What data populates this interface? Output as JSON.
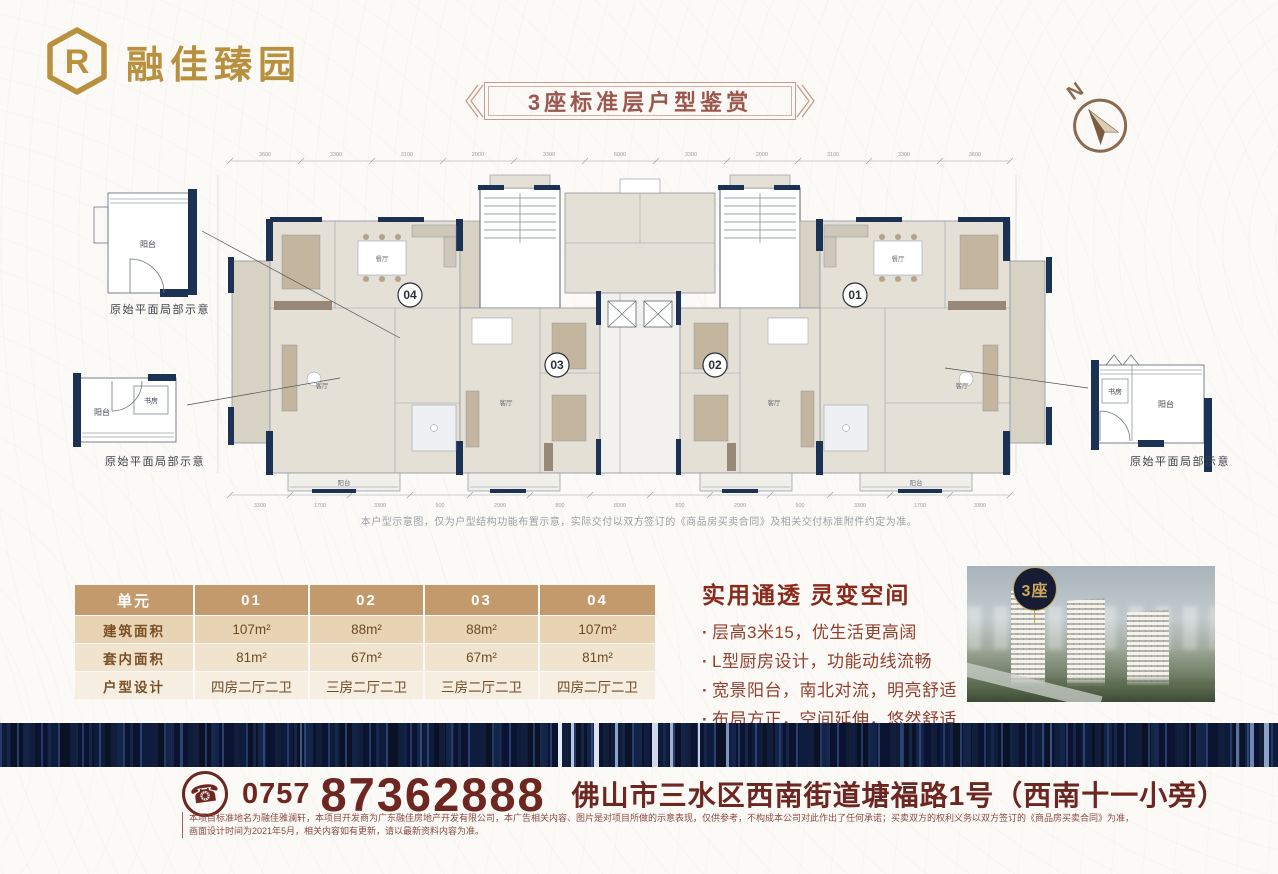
{
  "brand": {
    "logo_mark": "R",
    "logo_text": "融佳臻园"
  },
  "banner": {
    "title": "3座标准层户型鉴赏"
  },
  "compass": {
    "label": "N"
  },
  "floor_plan": {
    "unit_badges": [
      "04",
      "03",
      "02",
      "01"
    ],
    "room_labels": [
      "餐厅",
      "客厅",
      "阳台",
      "餐厅",
      "客厅",
      "阳台",
      "客厅",
      "客厅"
    ],
    "dimensions_top": [
      "3600",
      "3300",
      "3100",
      "2000",
      "3300",
      "6000",
      "3300",
      "2000",
      "3100",
      "3300",
      "3600"
    ],
    "dimensions_bottom": [
      "3300",
      "1700",
      "3300",
      "900",
      "2900",
      "800",
      "8000",
      "800",
      "2900",
      "900",
      "3300",
      "1700",
      "3300"
    ],
    "insets": [
      {
        "caption": "原始平面局部示意",
        "rooms": [
          "阳台"
        ]
      },
      {
        "caption": "原始平面局部示意",
        "rooms": [
          "阳台",
          "书房"
        ]
      },
      {
        "caption": "原始平面局部示意",
        "rooms": [
          "书房",
          "阳台"
        ]
      }
    ],
    "disclaimer": "本户型示意图，仅为户型结构功能布置示意，实际交付以双方签订的《商品房买卖合同》及相关交付标准附件约定为准。"
  },
  "units_table": {
    "headers": [
      "单元",
      "01",
      "02",
      "03",
      "04"
    ],
    "rows": [
      {
        "label": "建筑面积",
        "values": [
          "107m²",
          "88m²",
          "88m²",
          "107m²"
        ]
      },
      {
        "label": "套内面积",
        "values": [
          "81m²",
          "67m²",
          "67m²",
          "81m²"
        ]
      },
      {
        "label": "户型设计",
        "values": [
          "四房二厅二卫",
          "三房二厅二卫",
          "三房二厅二卫",
          "四房二厅二卫"
        ]
      }
    ]
  },
  "selling_points": {
    "title": "实用通透 灵变空间",
    "bullet_marker": "·",
    "bullets": [
      "层高3米15，优生活更高阔",
      "L型厨房设计，功能动线流畅",
      "宽景阳台，南北对流，明亮舒适",
      "布局方正，空间延伸，悠然舒适"
    ]
  },
  "render_image": {
    "badge": "3座"
  },
  "contact": {
    "phone_icon_glyph": "☎",
    "area_code": "0757",
    "phone": "87362888",
    "address": "佛山市三水区西南街道塘福路1号（西南十一小旁）"
  },
  "legal": {
    "text": "本项目标准地名为融佳雅澜轩，本项目开发商为广东融佳房地产开发有限公司，本广告相关内容、图片是对项目所做的示意表现，仅供参考，不构成本公司对此作出了任何承诺；买卖双方的权利义务以双方签订的《商品房买卖合同》为准，画面设计时间为2021年5月，相关内容如有更新，请以最新资料内容为准。"
  },
  "colors": {
    "accent_gold": "#b8903e",
    "maroon": "#6e2621",
    "title_red": "#8a2a1c",
    "table_header": "#c29a6b",
    "navy_wall": "#1c3254",
    "stripe_navy": "#0b1428"
  }
}
